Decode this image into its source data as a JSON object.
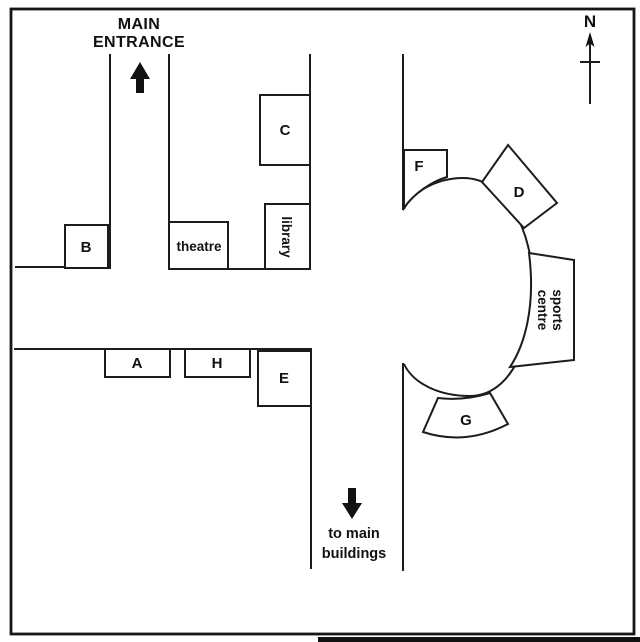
{
  "map": {
    "entrance": {
      "line1": "MAIN",
      "line2": "ENTRANCE"
    },
    "compass": {
      "label": "N"
    },
    "exit": {
      "line1": "to main",
      "line2": "buildings"
    },
    "buildings": {
      "a": "A",
      "b": "B",
      "c": "C",
      "d": "D",
      "e": "E",
      "f": "F",
      "g": "G",
      "h": "H",
      "theatre": "theatre",
      "library": "library",
      "sports_centre_line1": "sports",
      "sports_centre_line2": "centre"
    },
    "colors": {
      "line": "#1c1c1c",
      "background": "#ffffff"
    }
  }
}
